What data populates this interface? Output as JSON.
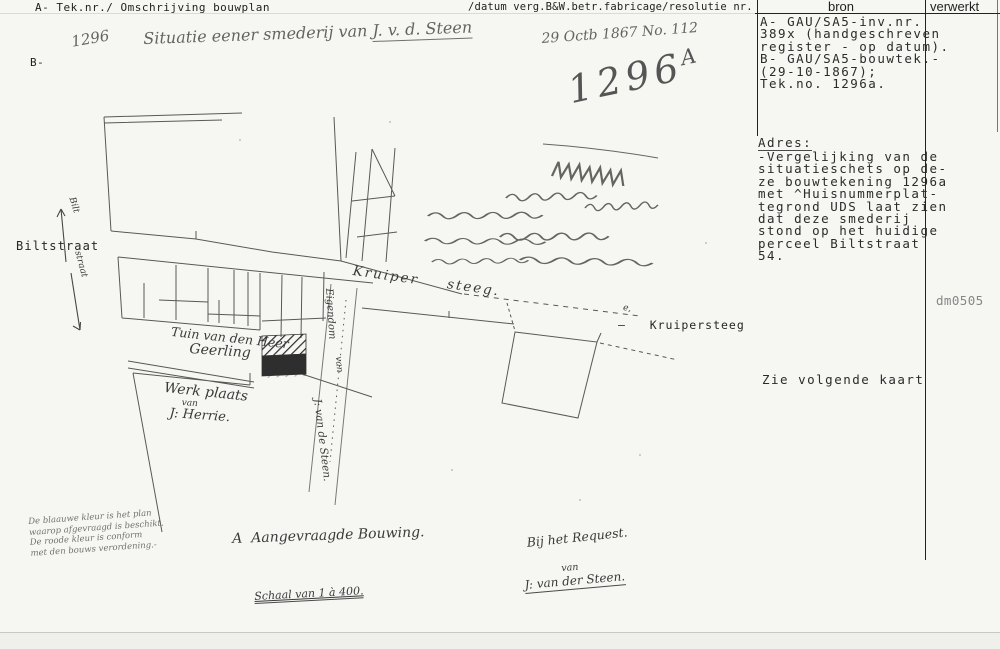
{
  "header": {
    "left_a": "A- Tek.nr./ Omschrijving bouwplan",
    "left_b": "B-",
    "middle": "/datum verg.B&W.betr.fabricage/resolutie nr.",
    "bron_label": "bron",
    "verwerkt_label": "verwerkt"
  },
  "bron_panel": {
    "lines": [
      "A- GAU/SA5-inv.nr.",
      "389x (handgeschreven",
      "register - op datum).",
      "B- GAU/SA5-bouwtek.-",
      "(29-10-1867);",
      "Tek.no. 1296a."
    ]
  },
  "adres_panel": {
    "heading": "Adres:",
    "lines": [
      "-Vergelijking van de",
      "situatieschets op de-",
      "ze bouwtekening 1296a",
      "met ^Huisnummerplat-",
      "tegrond UDS laat zien",
      "dat deze smederij",
      "stond op het huidige",
      "perceel Biltstraat",
      "54."
    ],
    "see_note": "Zie volgende kaart",
    "code": "dm0505"
  },
  "map": {
    "number_hw": "1296",
    "title_script": "Situatie eener smederij van ",
    "title_name": "J. v. d. Steen",
    "date_script": "29 Octb 1867 No. 112",
    "stamp_number": "1296",
    "stamp_suffix": "A",
    "biltstraat_label": "Biltstraat",
    "biltstraat_hw_1": "Bilt",
    "biltstraat_hw_2": "straat",
    "kruipersteeg_hw": "Kruiper  steeg.",
    "kruipersteeg_label": "—   Kruipersteeg",
    "scrawl_mark": "e,",
    "tuin_line1": "Tuin van den Heer",
    "tuin_line2": "Geerling",
    "werkplaats_line1": "Werk plaats",
    "werkplaats_line2": "van",
    "werkplaats_line3": "J: Herrie.",
    "lane_line1": "Eigendom",
    "lane_line2": "van",
    "lane_line3": "J: van de Steen.",
    "legend_a": "A  Aangevraagde Bouwing.",
    "scale_note": "Schaal van 1 à 400.",
    "request_line1": "Bij het Request.",
    "request_line2": "van",
    "request_line3": "J: van der Steen.",
    "approval_note_lines": [
      "De blaauwe kleur is het plan",
      "waarop afgevraagd is beschikt.",
      "De roode kleur is conform",
      "met den bouws verordening.-"
    ]
  },
  "colors": {
    "paper": "#f6f6f3",
    "ink_typed": "#262626",
    "ink_hand": "#3a3a3a",
    "plan_stroke": "#474747",
    "smithy_fill": "#2e2e2e"
  }
}
